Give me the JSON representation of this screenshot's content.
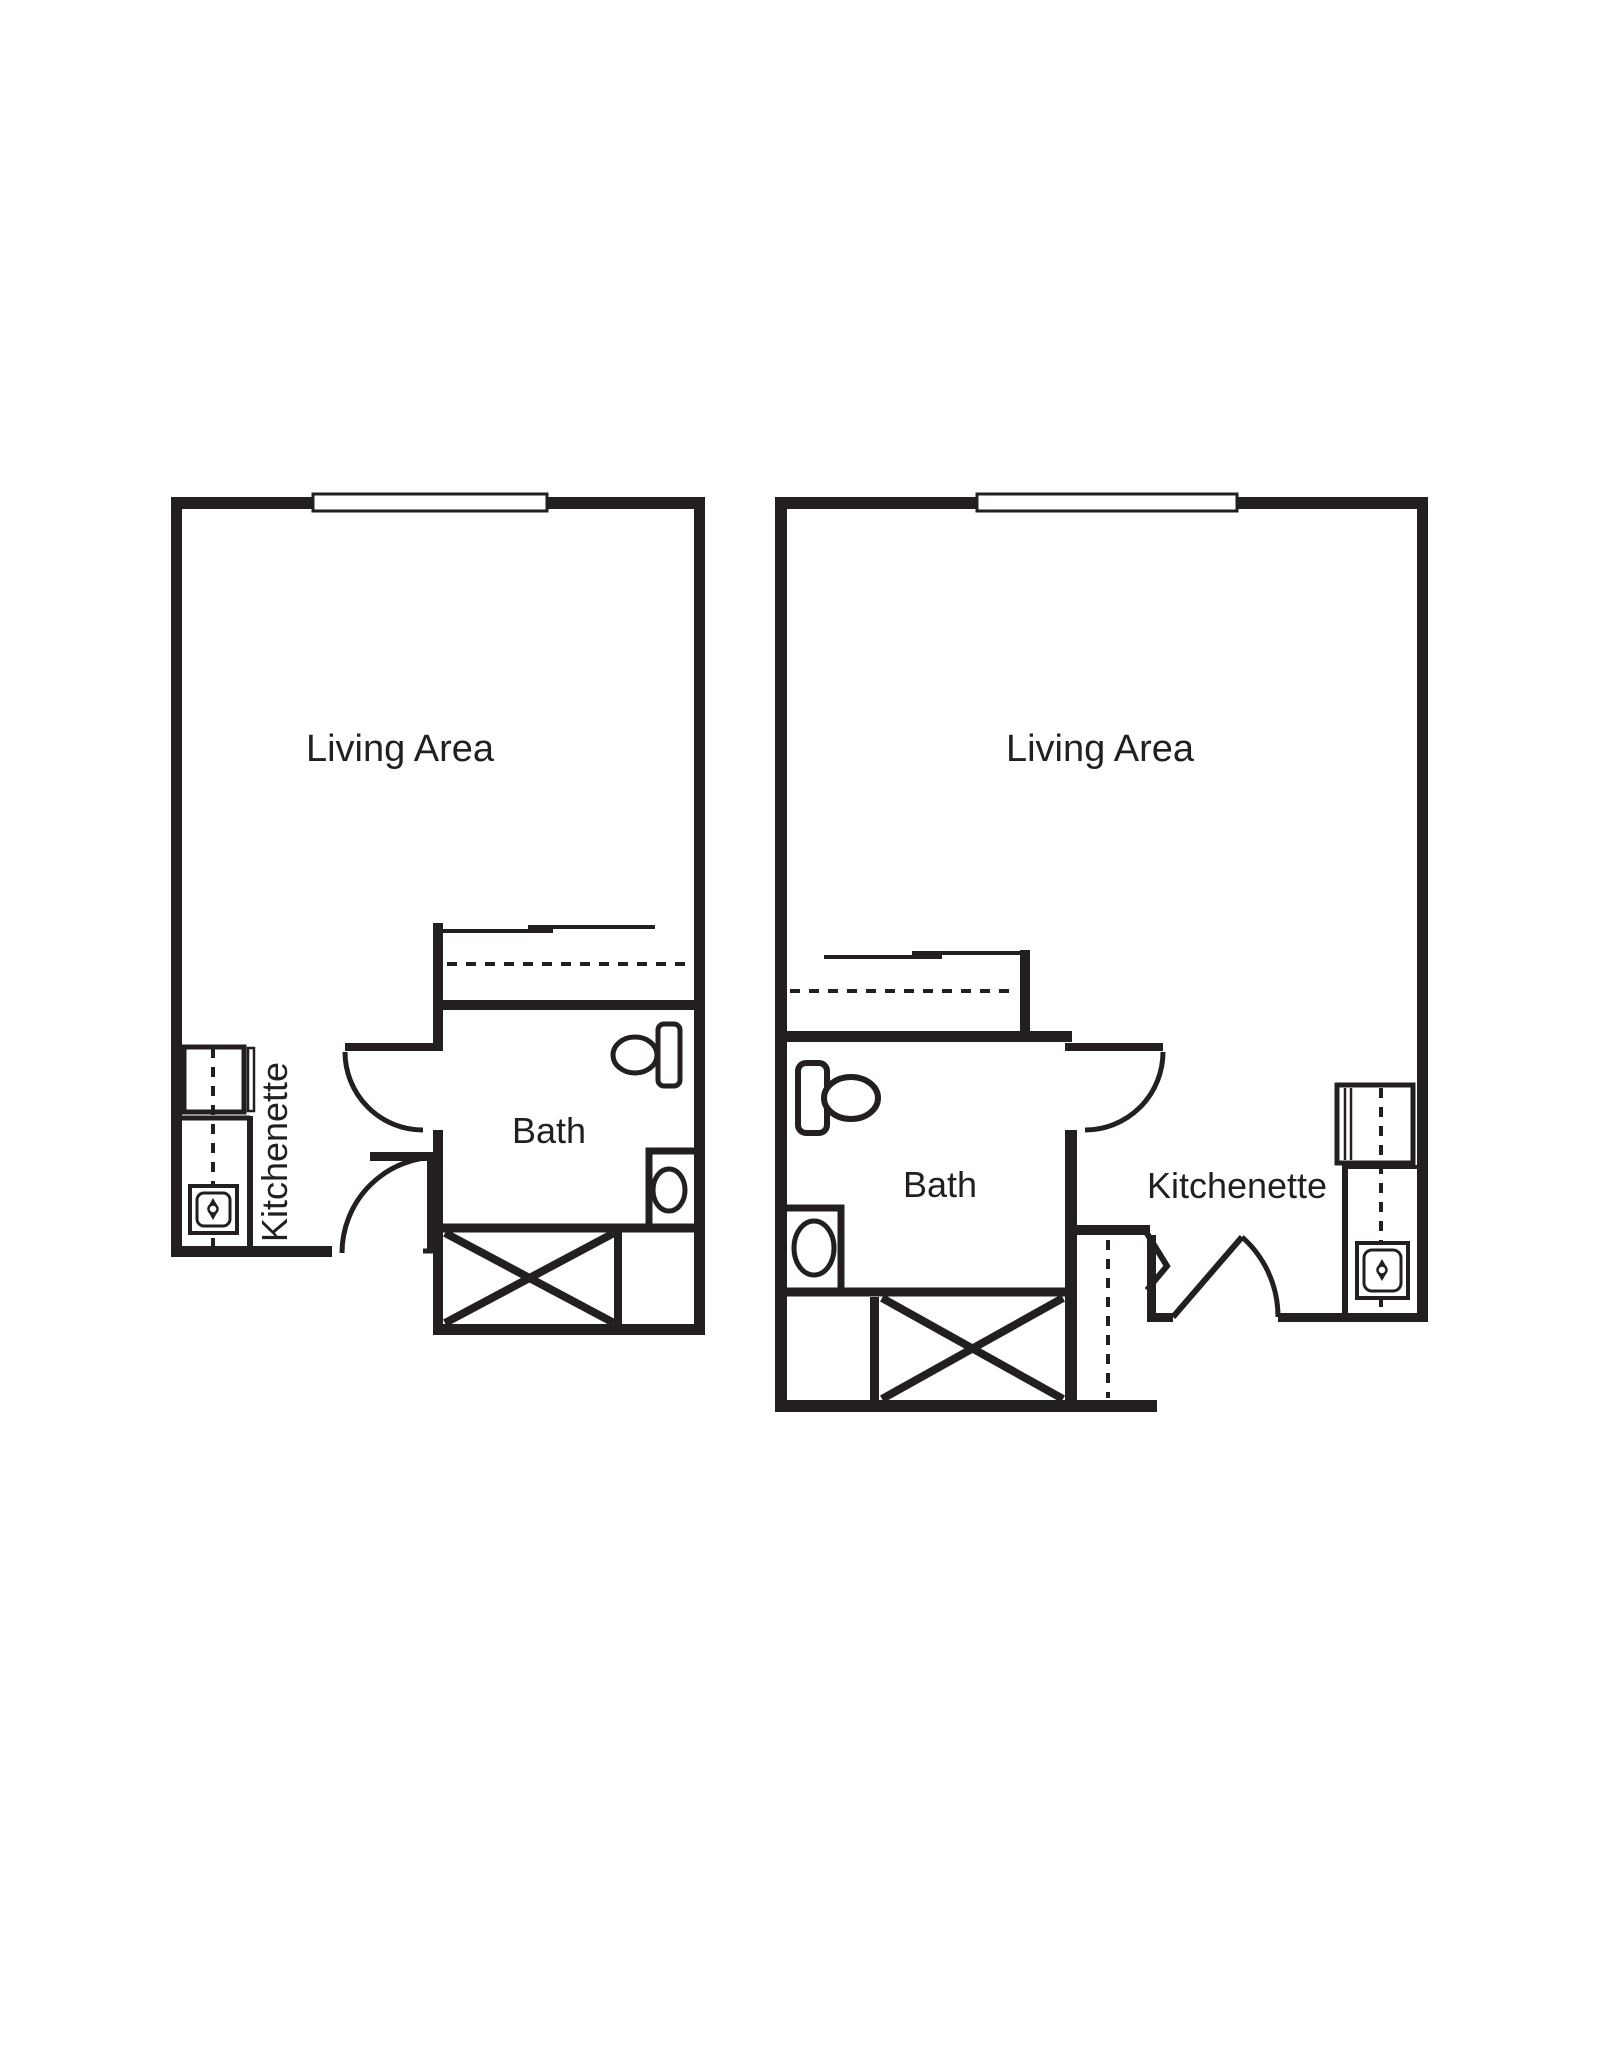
{
  "colors": {
    "wall": "#231f20",
    "background": "#ffffff"
  },
  "units": [
    {
      "name": "left-unit",
      "labels": {
        "living": "Living Area",
        "bath": "Bath",
        "kitchenette": "Kitchenette"
      }
    },
    {
      "name": "right-unit",
      "labels": {
        "living": "Living Area",
        "bath": "Bath",
        "kitchenette": "Kitchenette"
      }
    }
  ]
}
